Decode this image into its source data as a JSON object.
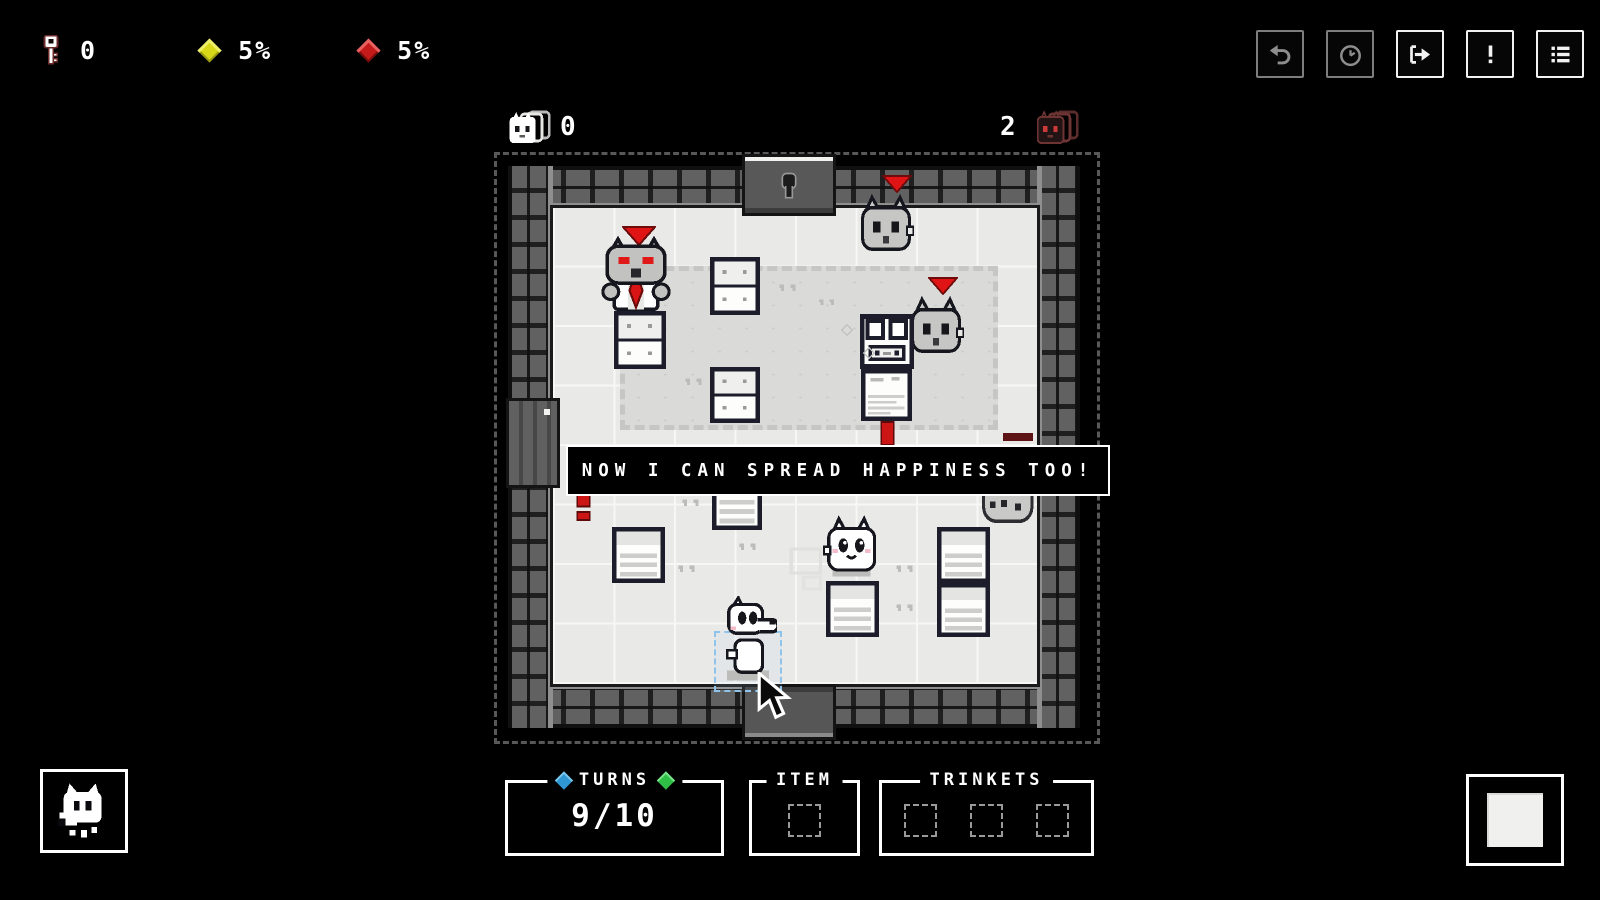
{
  "hud": {
    "key_count": "0",
    "happiness": "5%",
    "danger": "5%",
    "toolbar": [
      {
        "name": "undo-button",
        "icon": "undo",
        "enabled": false
      },
      {
        "name": "wait-button",
        "icon": "clock",
        "enabled": false
      },
      {
        "name": "end-turn-button",
        "icon": "exit-arrow",
        "enabled": true
      },
      {
        "name": "alerts-button",
        "icon": "exclamation",
        "enabled": true
      },
      {
        "name": "log-button",
        "icon": "list",
        "enabled": true
      }
    ]
  },
  "board": {
    "happy_count": "0",
    "angry_count": "2",
    "dialog_text": "NOW I CAN SPREAD HAPPINESS TOO!",
    "entities": [
      {
        "type": "triangle",
        "name": "aggro-marker",
        "x": 622,
        "y": 226,
        "w": 34,
        "h": 20,
        "interactable": false
      },
      {
        "type": "boss-cat",
        "name": "boss-cat",
        "x": 600,
        "y": 234,
        "w": 72,
        "h": 84,
        "interactable": true
      },
      {
        "type": "triangle",
        "name": "aggro-marker",
        "x": 882,
        "y": 175,
        "w": 30,
        "h": 18,
        "interactable": false
      },
      {
        "type": "gray-cat",
        "name": "angry-cat",
        "x": 858,
        "y": 194,
        "w": 56,
        "h": 62,
        "interactable": true
      },
      {
        "type": "triangle",
        "name": "aggro-marker",
        "x": 928,
        "y": 277,
        "w": 30,
        "h": 18,
        "interactable": false
      },
      {
        "type": "gray-cat",
        "name": "angry-cat",
        "x": 908,
        "y": 296,
        "w": 56,
        "h": 62,
        "interactable": true
      },
      {
        "type": "dresser",
        "name": "dresser",
        "x": 710,
        "y": 257,
        "w": 50,
        "h": 58,
        "interactable": true
      },
      {
        "type": "dresser",
        "name": "dresser",
        "x": 614,
        "y": 311,
        "w": 52,
        "h": 58,
        "interactable": true
      },
      {
        "type": "dresser",
        "name": "dresser",
        "x": 710,
        "y": 367,
        "w": 50,
        "h": 56,
        "interactable": true
      },
      {
        "type": "cabinet",
        "name": "cabinet",
        "x": 860,
        "y": 314,
        "w": 54,
        "h": 55,
        "interactable": true
      },
      {
        "type": "desk",
        "name": "desk",
        "x": 861,
        "y": 369,
        "w": 51,
        "h": 52,
        "interactable": true
      },
      {
        "type": "paw",
        "name": "paw-print",
        "x": 776,
        "y": 280,
        "w": 26,
        "h": 14,
        "interactable": false
      },
      {
        "type": "paw",
        "name": "paw-print",
        "x": 816,
        "y": 295,
        "w": 24,
        "h": 13,
        "interactable": false
      },
      {
        "type": "paw",
        "name": "paw-print",
        "x": 682,
        "y": 374,
        "w": 26,
        "h": 14,
        "interactable": false
      },
      {
        "type": "sparkle",
        "name": "sparkle",
        "x": 841,
        "y": 324,
        "w": 12,
        "h": 12,
        "interactable": false
      },
      {
        "type": "sparkle",
        "name": "sparkle",
        "x": 863,
        "y": 347,
        "w": 12,
        "h": 12,
        "interactable": false
      },
      {
        "type": "excl-small",
        "name": "alert-marker",
        "x": 879,
        "y": 421,
        "w": 17,
        "h": 25,
        "interactable": false
      },
      {
        "type": "dark-bar",
        "name": "faded-marker",
        "x": 1003,
        "y": 433,
        "w": 30,
        "h": 8,
        "interactable": false
      },
      {
        "type": "excl-red",
        "name": "alert-marker",
        "x": 575,
        "y": 483,
        "w": 17,
        "h": 38,
        "interactable": false
      },
      {
        "type": "bed",
        "name": "bed",
        "x": 712,
        "y": 473,
        "w": 50,
        "h": 57,
        "interactable": true
      },
      {
        "type": "spotted-cat",
        "name": "spotted-cat",
        "x": 979,
        "y": 473,
        "w": 56,
        "h": 50,
        "interactable": true
      },
      {
        "type": "bed",
        "name": "bed",
        "x": 612,
        "y": 527,
        "w": 53,
        "h": 56,
        "interactable": true
      },
      {
        "type": "bed",
        "name": "bed",
        "x": 826,
        "y": 581,
        "w": 53,
        "h": 56,
        "interactable": true
      },
      {
        "type": "bed",
        "name": "bed",
        "x": 937,
        "y": 527,
        "w": 53,
        "h": 56,
        "interactable": true
      },
      {
        "type": "bed",
        "name": "bed",
        "x": 937,
        "y": 583,
        "w": 53,
        "h": 54,
        "interactable": true
      },
      {
        "type": "paw",
        "name": "paw-print",
        "x": 679,
        "y": 495,
        "w": 26,
        "h": 14,
        "interactable": false
      },
      {
        "type": "paw",
        "name": "paw-print",
        "x": 736,
        "y": 539,
        "w": 26,
        "h": 14,
        "interactable": false
      },
      {
        "type": "paw",
        "name": "paw-print",
        "x": 675,
        "y": 561,
        "w": 26,
        "h": 14,
        "interactable": false
      },
      {
        "type": "paw",
        "name": "paw-print",
        "x": 893,
        "y": 561,
        "w": 26,
        "h": 14,
        "interactable": false
      },
      {
        "type": "paw",
        "name": "paw-print",
        "x": 893,
        "y": 600,
        "w": 26,
        "h": 14,
        "interactable": false
      },
      {
        "type": "ghost",
        "name": "ghost-preview",
        "x": 787,
        "y": 545,
        "w": 42,
        "h": 48,
        "interactable": false
      },
      {
        "type": "happy-cat",
        "name": "happy-cat",
        "x": 823,
        "y": 514,
        "w": 57,
        "h": 64,
        "interactable": true
      },
      {
        "type": "selection",
        "name": "selection-highlight",
        "x": 714,
        "y": 631,
        "w": 64,
        "h": 57,
        "interactable": false
      },
      {
        "type": "player-dog",
        "name": "player-character",
        "x": 719,
        "y": 596,
        "w": 58,
        "h": 88,
        "interactable": true
      }
    ]
  },
  "bottom": {
    "turns_label": "TURNS",
    "turns_value": "9/10",
    "item_label": "ITEM",
    "item_slots": 1,
    "trinkets_label": "TRINKETS",
    "trinket_slots": 3
  },
  "colors": {
    "alert_red": "#d81616",
    "happiness_yellow": "#d8d818",
    "turns_blue": "#2e96d2",
    "turns_green": "#2fbe46",
    "floor": "#e9e9e7",
    "carpet": "#dadad8"
  }
}
